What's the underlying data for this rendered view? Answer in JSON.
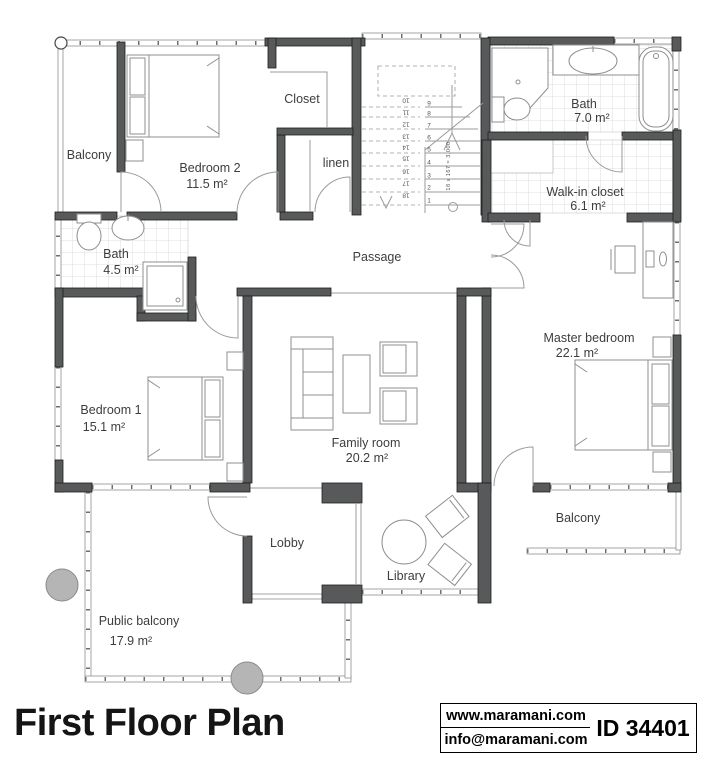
{
  "meta": {
    "title": "First Floor Plan",
    "website": "www.maramani.com",
    "email": "info@maramani.com",
    "plan_id": "ID 34401"
  },
  "colors": {
    "wall": "#58595b",
    "line": "#9b9b9b",
    "text": "#3d3d3d"
  },
  "rooms": {
    "balcony_top": {
      "name": "Balcony"
    },
    "bedroom2": {
      "name": "Bedroom 2",
      "area": "11.5 m²"
    },
    "closet": {
      "name": "Closet"
    },
    "linen": {
      "name": "linen"
    },
    "bath_upper": {
      "name": "Bath",
      "area": "7.0 m²"
    },
    "walkin_closet": {
      "name": "Walk-in closet",
      "area": "6.1 m²"
    },
    "bath_lower": {
      "name": "Bath",
      "area": "4.5 m²"
    },
    "passage": {
      "name": "Passage"
    },
    "bedroom1": {
      "name": "Bedroom 1",
      "area": "15.1 m²"
    },
    "family_room": {
      "name": "Family room",
      "area": "20.2 m²"
    },
    "master_bedroom": {
      "name": "Master bedroom",
      "area": "22.1 m²"
    },
    "balcony_right": {
      "name": "Balcony"
    },
    "lobby": {
      "name": "Lobby"
    },
    "library": {
      "name": "Library"
    },
    "public_balcony": {
      "name": "Public balcony",
      "area": "17.9 m²"
    }
  },
  "stairs": {
    "note": "18 x 167 = 3,000",
    "up": [
      "1",
      "2",
      "3",
      "4",
      "5",
      "6",
      "7",
      "8",
      "9"
    ],
    "down": [
      "10",
      "11",
      "12",
      "13",
      "14",
      "15",
      "16",
      "17",
      "18"
    ]
  }
}
